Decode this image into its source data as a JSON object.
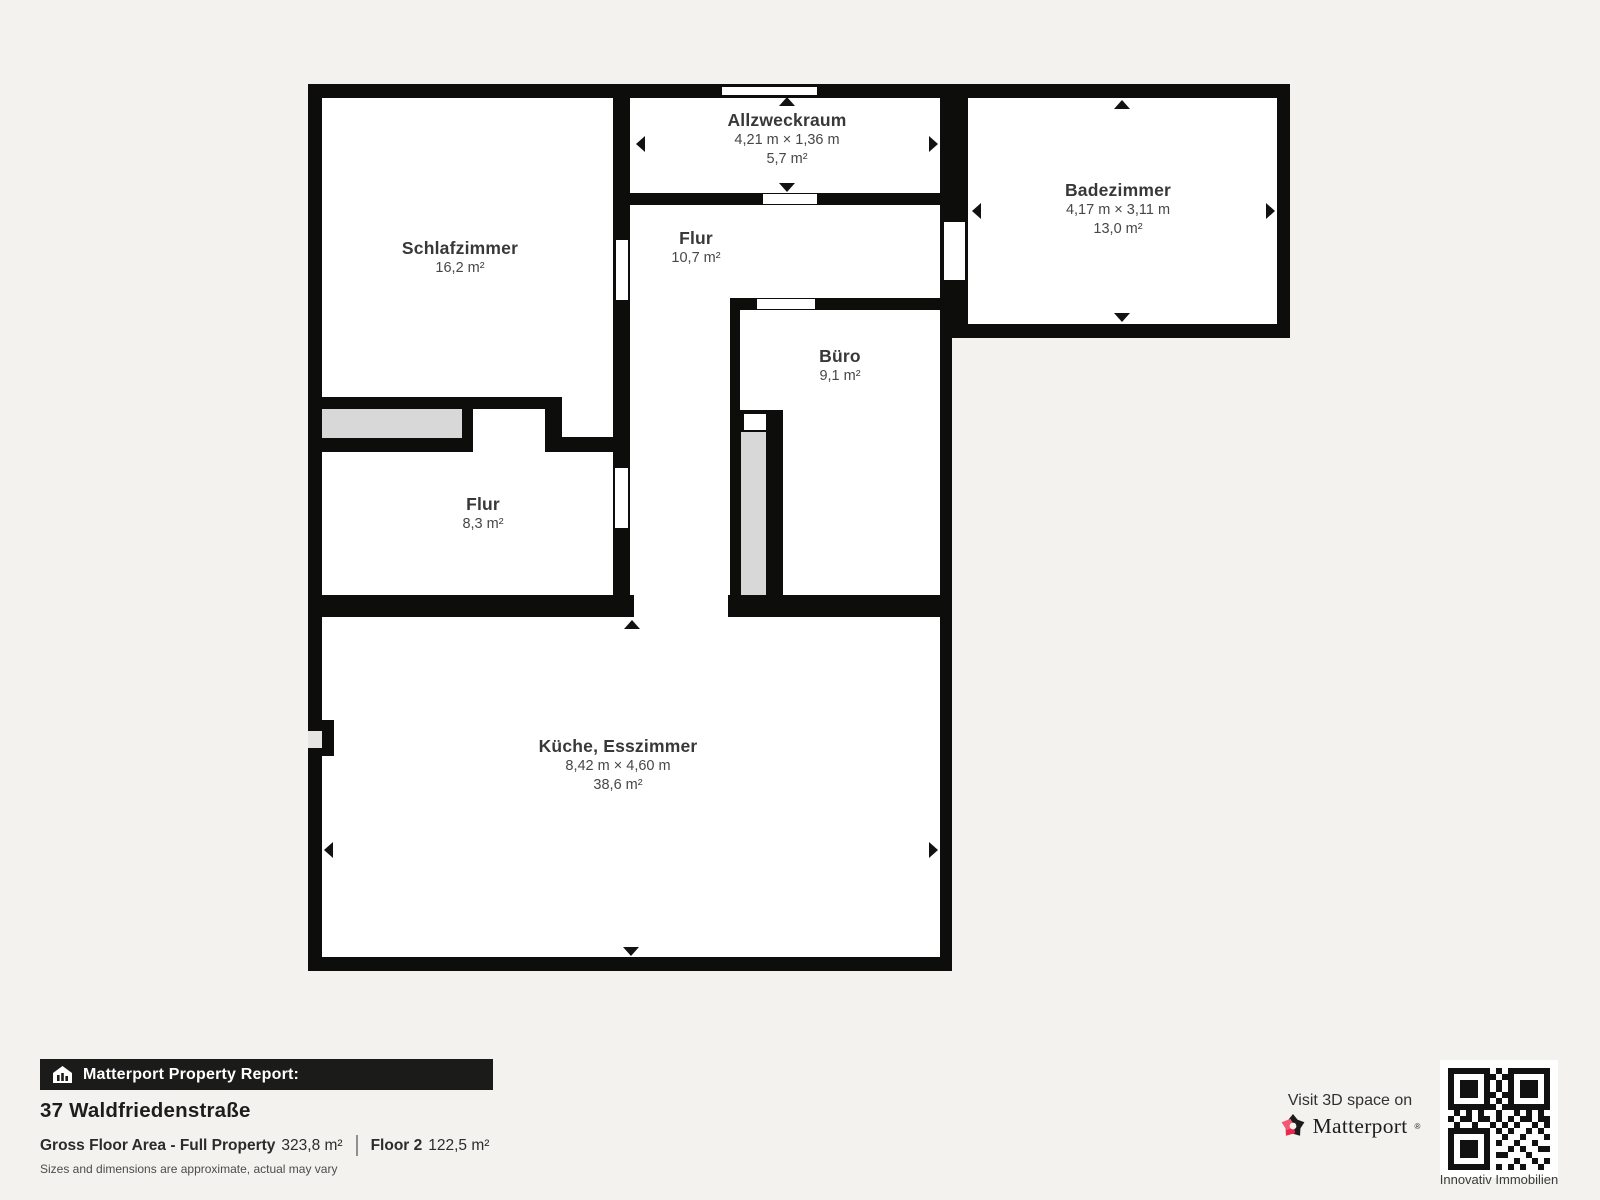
{
  "colors": {
    "background": "#f4f2ef",
    "wall": "#0d0d0c",
    "stairs_gray": "#d8d8d8",
    "matterport_red": "#e8274b",
    "matterport_pink": "#f25774"
  },
  "rooms": [
    {
      "id": "schlafzimmer",
      "name": "Schlafzimmer",
      "area": "16,2 m²"
    },
    {
      "id": "allzweckraum",
      "name": "Allzweckraum",
      "dims": "4,21 m × 1,36 m",
      "area": "5,7 m²"
    },
    {
      "id": "flur-og",
      "name": "Flur",
      "area": "10,7 m²"
    },
    {
      "id": "badezimmer",
      "name": "Badezimmer",
      "dims": "4,17 m × 3,11 m",
      "area": "13,0 m²"
    },
    {
      "id": "buero",
      "name": "Büro",
      "area": "9,1 m²"
    },
    {
      "id": "flur-klein",
      "name": "Flur",
      "area": "8,3 m²"
    },
    {
      "id": "kueche",
      "name": "Küche, Esszimmer",
      "dims": "8,42 m × 4,60 m",
      "area": "38,6 m²"
    }
  ],
  "footer": {
    "banner": "Matterport Property Report:",
    "address": "37 Waldfriedenstraße",
    "gfa_label": "Gross Floor Area - Full Property",
    "gfa_value": "323,8 m²",
    "floor_label": "Floor 2",
    "floor_value": "122,5 m²",
    "disclaimer": "Sizes and dimensions are approximate, actual may vary"
  },
  "branding": {
    "visit": "Visit 3D space on",
    "wordmark": "Matterport",
    "wordmark_mark": "®",
    "qr_caption": "Innovativ Immobilien"
  }
}
